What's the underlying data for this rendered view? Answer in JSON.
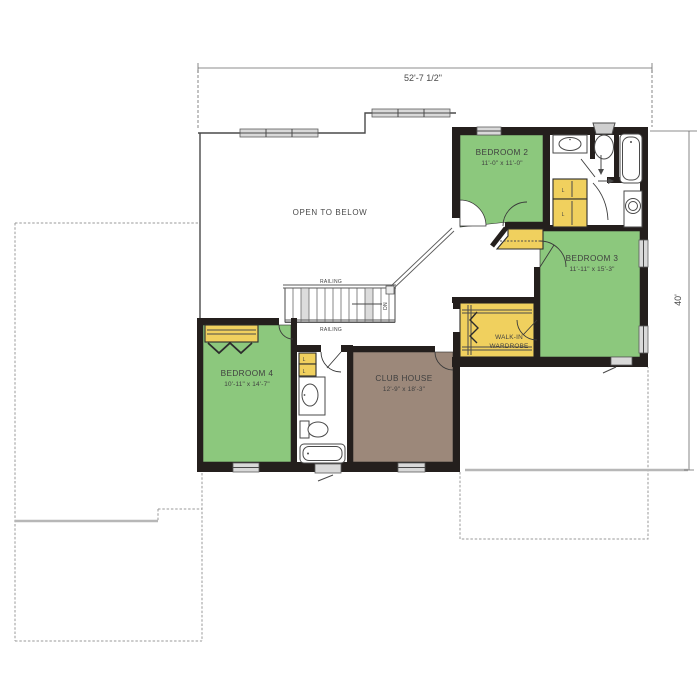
{
  "dimensions": {
    "width_label": "52'-7 1/2\"",
    "depth_label": "40'"
  },
  "rooms": {
    "bedroom2": {
      "name": "BEDROOM 2",
      "size": "11'-0\" x 11'-0\""
    },
    "bedroom3": {
      "name": "BEDROOM 3",
      "size": "11'-11\" x 15'-3\""
    },
    "bedroom4": {
      "name": "BEDROOM 4",
      "size": "10'-11\" x 14'-7\""
    },
    "club_house": {
      "name": "CLUB HOUSE",
      "size": "12'-9\" x 18'-3\""
    },
    "walk_in_wardrobe": {
      "line1": "WALK-IN",
      "line2": "WARDROBE"
    }
  },
  "labels": {
    "open_to_below": "OPEN TO BELOW",
    "railing": "RAILING",
    "down": "DN",
    "linen": "L"
  },
  "colors": {
    "room-green": "#8cc87d",
    "closet-yellow": "#f0d05e",
    "club-brown": "#9c887a",
    "wall": "#241f1d",
    "window-fill": "#d9d9d9",
    "outline-gray": "#9a9a9a",
    "text": "#3f3f3f"
  }
}
